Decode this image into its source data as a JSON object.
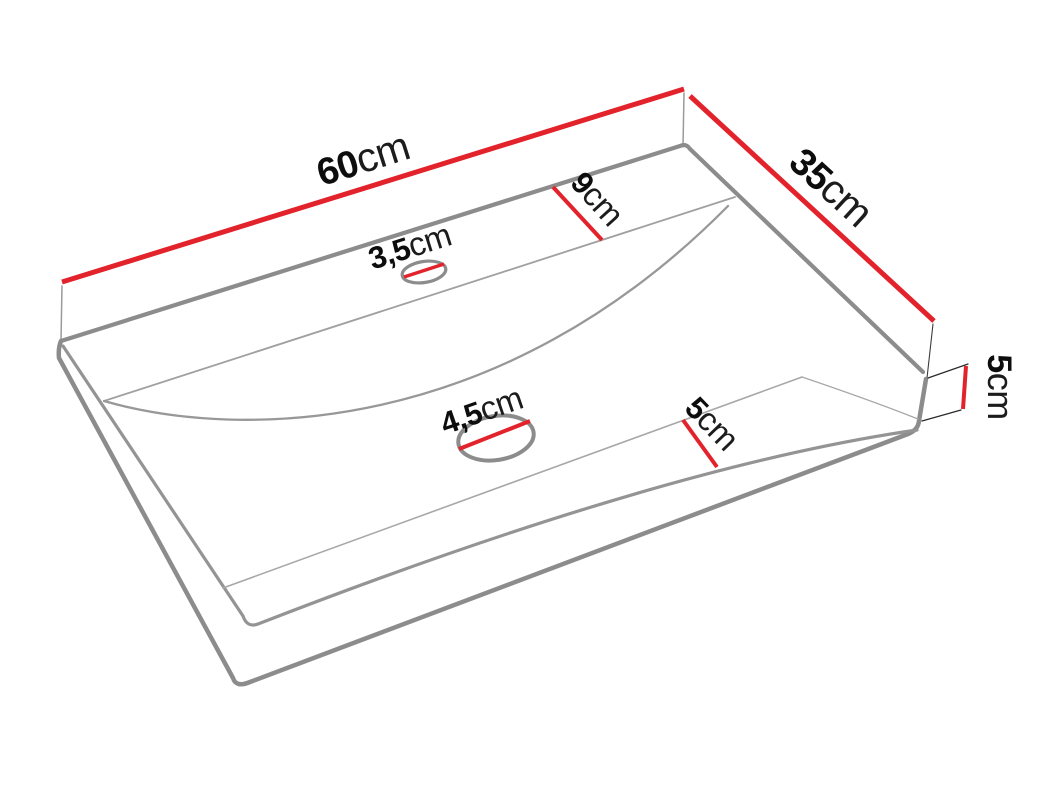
{
  "page": {
    "background": "#ffffff",
    "width": 1054,
    "height": 791
  },
  "diagram": {
    "type": "perspective technical drawing",
    "subject": "rectangular countertop washbasin with dimension annotations",
    "colors": {
      "dimension_line": "#e3232c",
      "outline": "#8c8c8c",
      "inner_line": "#9c9c9c",
      "label_number": "#0d0d0d",
      "label_unit": "#1c1c1c"
    },
    "labels": {
      "width": {
        "value": "60",
        "unit": "cm",
        "feature": "top back edge (basin width)"
      },
      "depth": {
        "value": "35",
        "unit": "cm",
        "feature": "top right edge (basin depth)"
      },
      "deck": {
        "value": "9",
        "unit": "cm",
        "feature": "rear deck width"
      },
      "faucet_hole": {
        "value": "3,5",
        "unit": "cm",
        "feature": "faucet hole diameter"
      },
      "drain_hole": {
        "value": "4,5",
        "unit": "cm",
        "feature": "drain hole diameter"
      },
      "front_rim": {
        "value": "5",
        "unit": "cm",
        "feature": "front rim width"
      },
      "height": {
        "value": "5",
        "unit": "cm",
        "feature": "basin side height"
      }
    }
  }
}
